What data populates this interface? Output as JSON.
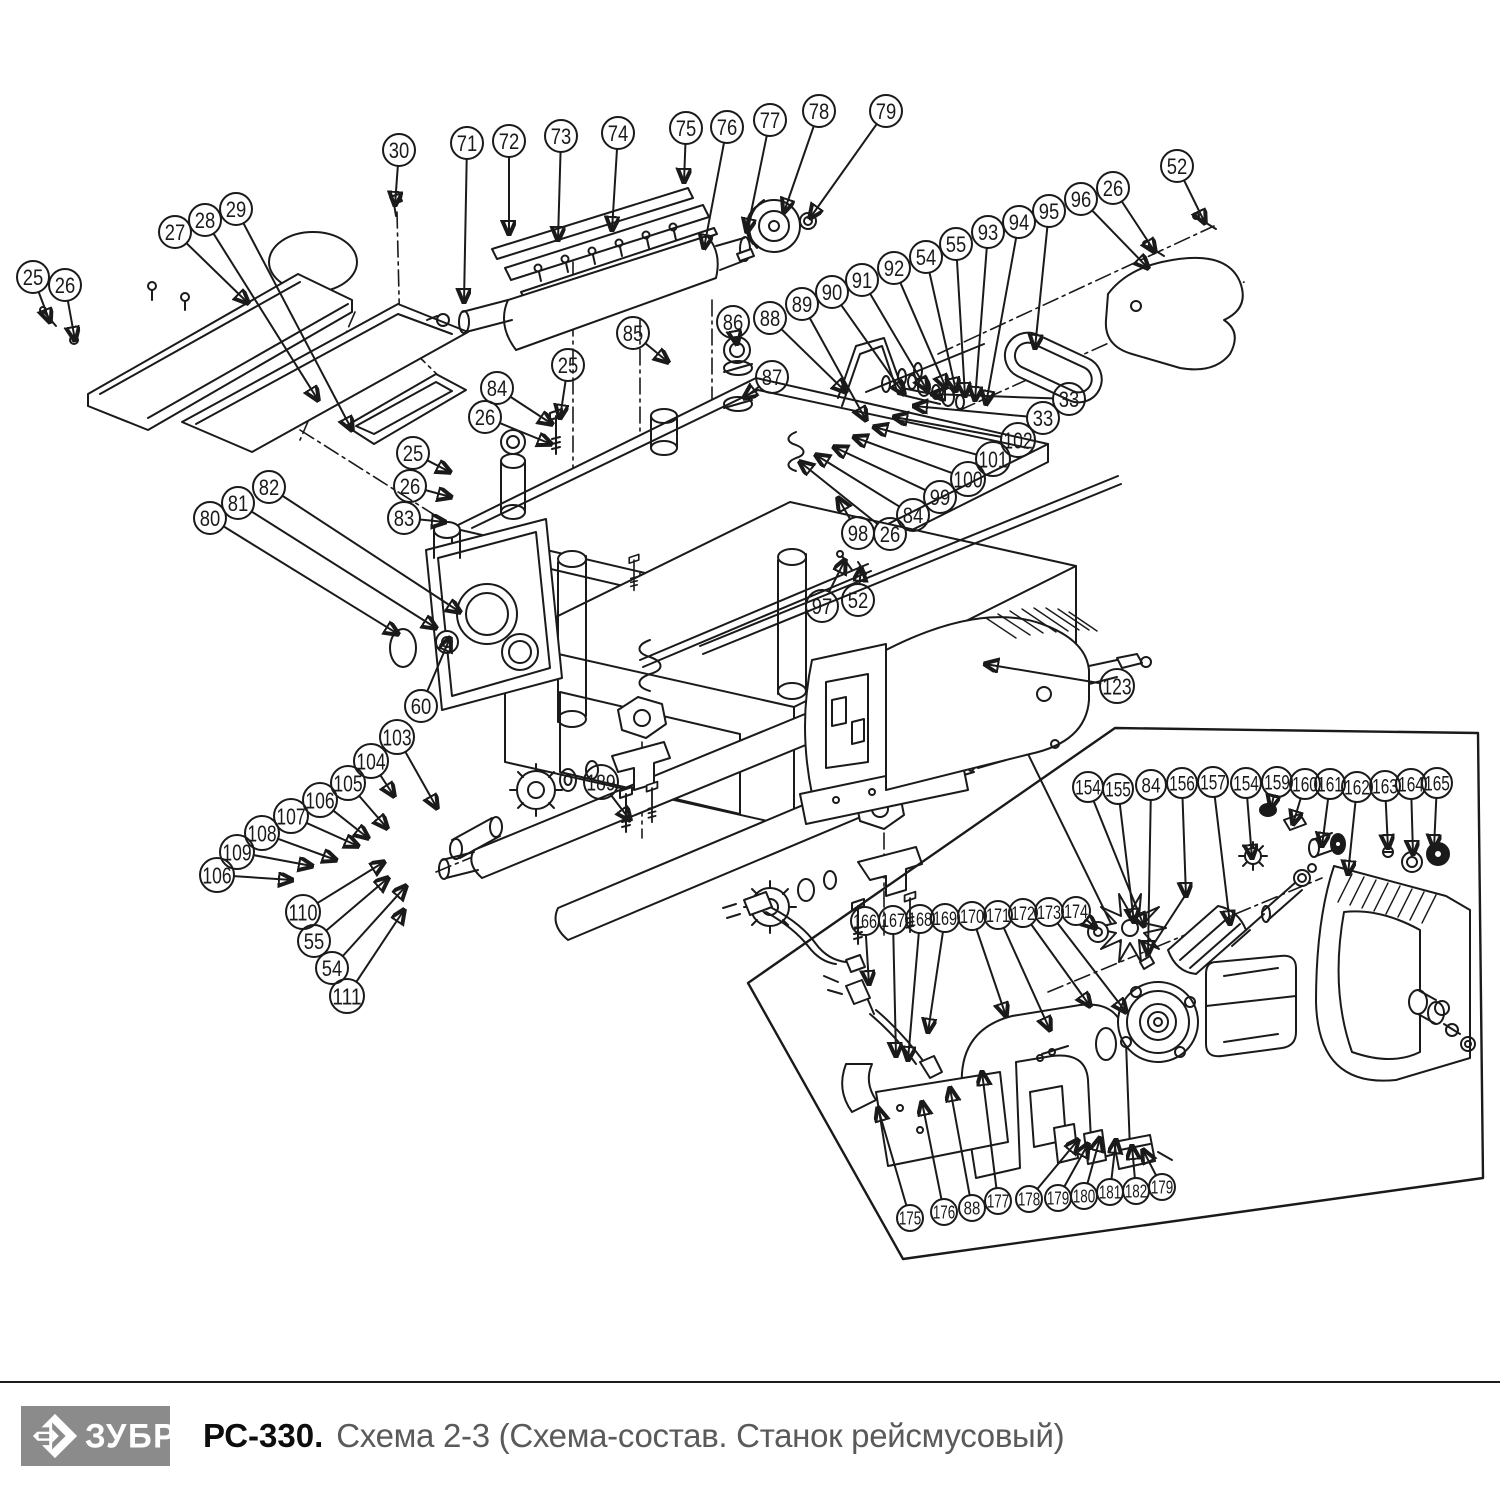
{
  "colors": {
    "line": "#1a1a1a",
    "logo_bg": "#8b8b8b"
  },
  "footer": {
    "brand": "ЗУБР",
    "model": "РС-330.",
    "subtitle": "Схема 2-3 (Схема-состав. Станок рейсмусовый)"
  },
  "callouts": [
    {
      "n": "25",
      "x": 33,
      "y": 277,
      "r": 16,
      "lx": 50,
      "ly": 322
    },
    {
      "n": "26",
      "x": 65,
      "y": 285,
      "r": 16,
      "lx": 75,
      "ly": 340
    },
    {
      "n": "27",
      "x": 175,
      "y": 232,
      "r": 16,
      "lx": 248,
      "ly": 303
    },
    {
      "n": "28",
      "x": 205,
      "y": 220,
      "r": 16,
      "lx": 318,
      "ly": 400
    },
    {
      "n": "29",
      "x": 236,
      "y": 209,
      "r": 16,
      "lx": 352,
      "ly": 430
    },
    {
      "n": "30",
      "x": 399,
      "y": 150,
      "r": 16,
      "lx": 395,
      "ly": 205
    },
    {
      "n": "71",
      "x": 467,
      "y": 143,
      "r": 16,
      "lx": 464,
      "ly": 302
    },
    {
      "n": "72",
      "x": 509,
      "y": 141,
      "r": 16,
      "lx": 509,
      "ly": 234
    },
    {
      "n": "73",
      "x": 561,
      "y": 136,
      "r": 16,
      "lx": 558,
      "ly": 240
    },
    {
      "n": "74",
      "x": 618,
      "y": 133,
      "r": 16,
      "lx": 612,
      "ly": 230
    },
    {
      "n": "75",
      "x": 686,
      "y": 128,
      "r": 16,
      "lx": 684,
      "ly": 182
    },
    {
      "n": "76",
      "x": 727,
      "y": 127,
      "r": 16,
      "lx": 704,
      "ly": 248
    },
    {
      "n": "77",
      "x": 770,
      "y": 120,
      "r": 16,
      "lx": 747,
      "ly": 232
    },
    {
      "n": "78",
      "x": 819,
      "y": 111,
      "r": 16,
      "lx": 784,
      "ly": 212
    },
    {
      "n": "79",
      "x": 886,
      "y": 111,
      "r": 16,
      "lx": 810,
      "ly": 218
    },
    {
      "n": "85",
      "x": 633,
      "y": 333,
      "r": 16,
      "lx": 668,
      "ly": 362
    },
    {
      "n": "86",
      "x": 733,
      "y": 322,
      "r": 16,
      "lx": 737,
      "ly": 344
    },
    {
      "n": "87",
      "x": 772,
      "y": 377,
      "r": 16,
      "lx": 744,
      "ly": 398
    },
    {
      "n": "84",
      "x": 497,
      "y": 388,
      "r": 16,
      "lx": 552,
      "ly": 424
    },
    {
      "n": "25",
      "x": 568,
      "y": 365,
      "r": 16,
      "lx": 560,
      "ly": 418
    },
    {
      "n": "26",
      "x": 485,
      "y": 417,
      "r": 16,
      "lx": 551,
      "ly": 444
    },
    {
      "n": "88",
      "x": 770,
      "y": 318,
      "r": 16,
      "lx": 846,
      "ly": 392
    },
    {
      "n": "89",
      "x": 802,
      "y": 304,
      "r": 16,
      "lx": 866,
      "ly": 420
    },
    {
      "n": "90",
      "x": 832,
      "y": 292,
      "r": 16,
      "lx": 904,
      "ly": 394
    },
    {
      "n": "91",
      "x": 862,
      "y": 280,
      "r": 16,
      "lx": 927,
      "ly": 390
    },
    {
      "n": "92",
      "x": 894,
      "y": 268,
      "r": 16,
      "lx": 946,
      "ly": 388
    },
    {
      "n": "54",
      "x": 926,
      "y": 257,
      "r": 16,
      "lx": 956,
      "ly": 391
    },
    {
      "n": "55",
      "x": 956,
      "y": 244,
      "r": 16,
      "lx": 965,
      "ly": 396
    },
    {
      "n": "93",
      "x": 988,
      "y": 232,
      "r": 16,
      "lx": 975,
      "ly": 400
    },
    {
      "n": "94",
      "x": 1019,
      "y": 222,
      "r": 16,
      "lx": 986,
      "ly": 404
    },
    {
      "n": "95",
      "x": 1049,
      "y": 211,
      "r": 16,
      "lx": 1035,
      "ly": 348
    },
    {
      "n": "96",
      "x": 1081,
      "y": 199,
      "r": 16,
      "lx": 1148,
      "ly": 268
    },
    {
      "n": "26",
      "x": 1113,
      "y": 188,
      "r": 16,
      "lx": 1155,
      "ly": 252
    },
    {
      "n": "52",
      "x": 1177,
      "y": 166,
      "r": 16,
      "lx": 1205,
      "ly": 223
    },
    {
      "n": "33",
      "x": 1069,
      "y": 399,
      "r": 16,
      "lx": 932,
      "ly": 394
    },
    {
      "n": "33",
      "x": 1043,
      "y": 418,
      "r": 16,
      "lx": 914,
      "ly": 406
    },
    {
      "n": "102",
      "x": 1018,
      "y": 440,
      "r": 17,
      "lx": 894,
      "ly": 417
    },
    {
      "n": "101",
      "x": 993,
      "y": 459,
      "r": 17,
      "lx": 874,
      "ly": 427
    },
    {
      "n": "100",
      "x": 968,
      "y": 479,
      "r": 17,
      "lx": 854,
      "ly": 437
    },
    {
      "n": "99",
      "x": 940,
      "y": 497,
      "r": 16,
      "lx": 834,
      "ly": 447
    },
    {
      "n": "84",
      "x": 913,
      "y": 515,
      "r": 16,
      "lx": 816,
      "ly": 455
    },
    {
      "n": "26",
      "x": 890,
      "y": 534,
      "r": 16,
      "lx": 800,
      "ly": 462
    },
    {
      "n": "98",
      "x": 858,
      "y": 533,
      "r": 16,
      "lx": 838,
      "ly": 498
    },
    {
      "n": "97",
      "x": 822,
      "y": 606,
      "r": 16,
      "lx": 845,
      "ly": 560
    },
    {
      "n": "52",
      "x": 858,
      "y": 600,
      "r": 16,
      "lx": 861,
      "ly": 568
    },
    {
      "n": "25",
      "x": 413,
      "y": 453,
      "r": 16,
      "lx": 450,
      "ly": 472
    },
    {
      "n": "26",
      "x": 410,
      "y": 486,
      "r": 16,
      "lx": 451,
      "ly": 497
    },
    {
      "n": "83",
      "x": 404,
      "y": 518,
      "r": 16,
      "lx": 445,
      "ly": 522
    },
    {
      "n": "82",
      "x": 269,
      "y": 487,
      "r": 16,
      "lx": 460,
      "ly": 612
    },
    {
      "n": "81",
      "x": 238,
      "y": 503,
      "r": 16,
      "lx": 436,
      "ly": 628
    },
    {
      "n": "80",
      "x": 210,
      "y": 518,
      "r": 16,
      "lx": 398,
      "ly": 634
    },
    {
      "n": "60",
      "x": 421,
      "y": 706,
      "r": 16,
      "lx": 450,
      "ly": 638
    },
    {
      "n": "103",
      "x": 397,
      "y": 737,
      "r": 17,
      "lx": 437,
      "ly": 808
    },
    {
      "n": "104",
      "x": 371,
      "y": 761,
      "r": 17,
      "lx": 394,
      "ly": 796
    },
    {
      "n": "105",
      "x": 348,
      "y": 783,
      "r": 17,
      "lx": 387,
      "ly": 828
    },
    {
      "n": "106",
      "x": 320,
      "y": 800,
      "r": 17,
      "lx": 368,
      "ly": 838
    },
    {
      "n": "107",
      "x": 291,
      "y": 816,
      "r": 17,
      "lx": 358,
      "ly": 846
    },
    {
      "n": "108",
      "x": 262,
      "y": 833,
      "r": 17,
      "lx": 336,
      "ly": 860
    },
    {
      "n": "109",
      "x": 237,
      "y": 852,
      "r": 17,
      "lx": 312,
      "ly": 866
    },
    {
      "n": "106",
      "x": 217,
      "y": 875,
      "r": 17,
      "lx": 292,
      "ly": 880
    },
    {
      "n": "110",
      "x": 303,
      "y": 912,
      "r": 17,
      "lx": 384,
      "ly": 862
    },
    {
      "n": "55",
      "x": 314,
      "y": 941,
      "r": 16,
      "lx": 388,
      "ly": 878
    },
    {
      "n": "54",
      "x": 332,
      "y": 968,
      "r": 16,
      "lx": 406,
      "ly": 886
    },
    {
      "n": "111",
      "x": 347,
      "y": 996,
      "r": 17,
      "lx": 404,
      "ly": 910
    },
    {
      "n": "189",
      "x": 601,
      "y": 782,
      "r": 17,
      "lx": 630,
      "ly": 820
    },
    {
      "n": "123",
      "x": 1117,
      "y": 686,
      "r": 17,
      "lx": 985,
      "ly": 664
    },
    {
      "n": "154",
      "x": 1088,
      "y": 787,
      "r": 15,
      "lx": 1144,
      "ly": 926
    },
    {
      "n": "155",
      "x": 1118,
      "y": 789,
      "r": 15,
      "lx": 1134,
      "ly": 922
    },
    {
      "n": "84",
      "x": 1151,
      "y": 785,
      "r": 15,
      "lx": 1148,
      "ly": 954
    },
    {
      "n": "156",
      "x": 1182,
      "y": 783,
      "r": 15,
      "lx": 1186,
      "ly": 896
    },
    {
      "n": "157",
      "x": 1213,
      "y": 782,
      "r": 15,
      "lx": 1230,
      "ly": 924
    },
    {
      "n": "154",
      "x": 1246,
      "y": 783,
      "r": 15,
      "lx": 1252,
      "ly": 858
    },
    {
      "n": "159",
      "x": 1277,
      "y": 782,
      "r": 15,
      "lx": 1271,
      "ly": 808
    },
    {
      "n": "160",
      "x": 1305,
      "y": 784,
      "r": 15,
      "lx": 1293,
      "ly": 824
    },
    {
      "n": "161",
      "x": 1330,
      "y": 784,
      "r": 15,
      "lx": 1322,
      "ly": 846
    },
    {
      "n": "162",
      "x": 1357,
      "y": 787,
      "r": 15,
      "lx": 1348,
      "ly": 874
    },
    {
      "n": "163",
      "x": 1385,
      "y": 786,
      "r": 15,
      "lx": 1388,
      "ly": 848
    },
    {
      "n": "164",
      "x": 1411,
      "y": 784,
      "r": 15,
      "lx": 1413,
      "ly": 854
    },
    {
      "n": "165",
      "x": 1437,
      "y": 783,
      "r": 15,
      "lx": 1434,
      "ly": 848
    },
    {
      "n": "166",
      "x": 865,
      "y": 921,
      "r": 14,
      "lx": 869,
      "ly": 984
    },
    {
      "n": "167",
      "x": 893,
      "y": 920,
      "r": 14,
      "lx": 896,
      "ly": 1056
    },
    {
      "n": "168",
      "x": 920,
      "y": 919,
      "r": 14,
      "lx": 908,
      "ly": 1060
    },
    {
      "n": "169",
      "x": 945,
      "y": 918,
      "r": 14,
      "lx": 928,
      "ly": 1032
    },
    {
      "n": "170",
      "x": 972,
      "y": 916,
      "r": 14,
      "lx": 1006,
      "ly": 1016
    },
    {
      "n": "171",
      "x": 998,
      "y": 915,
      "r": 14,
      "lx": 1050,
      "ly": 1030
    },
    {
      "n": "172",
      "x": 1023,
      "y": 913,
      "r": 14,
      "lx": 1090,
      "ly": 1006
    },
    {
      "n": "173",
      "x": 1049,
      "y": 912,
      "r": 14,
      "lx": 1126,
      "ly": 1012
    },
    {
      "n": "174",
      "x": 1076,
      "y": 911,
      "r": 14,
      "lx": 1096,
      "ly": 928
    },
    {
      "n": "175",
      "x": 910,
      "y": 1218,
      "r": 13,
      "lx": 878,
      "ly": 1108
    },
    {
      "n": "176",
      "x": 944,
      "y": 1212,
      "r": 13,
      "lx": 922,
      "ly": 1102
    },
    {
      "n": "88",
      "x": 972,
      "y": 1208,
      "r": 13,
      "lx": 950,
      "ly": 1088
    },
    {
      "n": "177",
      "x": 998,
      "y": 1201,
      "r": 13,
      "lx": 982,
      "ly": 1072
    },
    {
      "n": "178",
      "x": 1029,
      "y": 1199,
      "r": 13,
      "lx": 1078,
      "ly": 1140
    },
    {
      "n": "179",
      "x": 1058,
      "y": 1198,
      "r": 13,
      "lx": 1088,
      "ly": 1144
    },
    {
      "n": "180",
      "x": 1084,
      "y": 1196,
      "r": 13,
      "lx": 1100,
      "ly": 1138
    },
    {
      "n": "181",
      "x": 1110,
      "y": 1192,
      "r": 13,
      "lx": 1116,
      "ly": 1140
    },
    {
      "n": "182",
      "x": 1136,
      "y": 1191,
      "r": 13,
      "lx": 1132,
      "ly": 1146
    },
    {
      "n": "179",
      "x": 1162,
      "y": 1187,
      "r": 13,
      "lx": 1143,
      "ly": 1150
    }
  ]
}
